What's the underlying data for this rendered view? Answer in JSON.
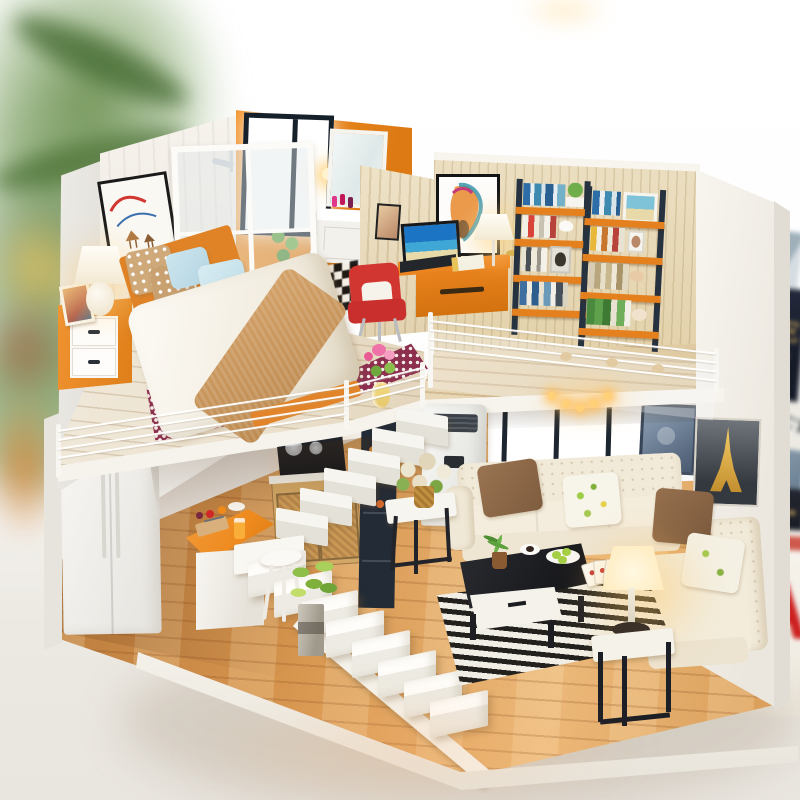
{
  "image": {
    "type": "photograph",
    "subject": "DIY miniature dollhouse kit — two-story loft apartment with bedroom, bathroom, study, kitchen and living room, displayed on a white table"
  },
  "background_props": {
    "book_stack": {
      "dark_book_text_line1": "ME",
      "dark_book_text_line2": "T",
      "white_book_text": "NOCT",
      "red_magazine_text": "CA"
    }
  },
  "palette": {
    "orange": "#ee8a1e",
    "orangeDeep": "#dd7a14",
    "navy": "#26323f",
    "maroon": "#8d3050",
    "chairRed": "#d23630",
    "magRed": "#cc1f1f",
    "gold": "#d9b05e",
    "cream": "#f2ead9",
    "woodFloor": "#d7964f",
    "loftFloor": "#ece2cf",
    "studyWall": "#ecdfc2",
    "glow": "#ffd27a",
    "green": "#7fb03c"
  }
}
